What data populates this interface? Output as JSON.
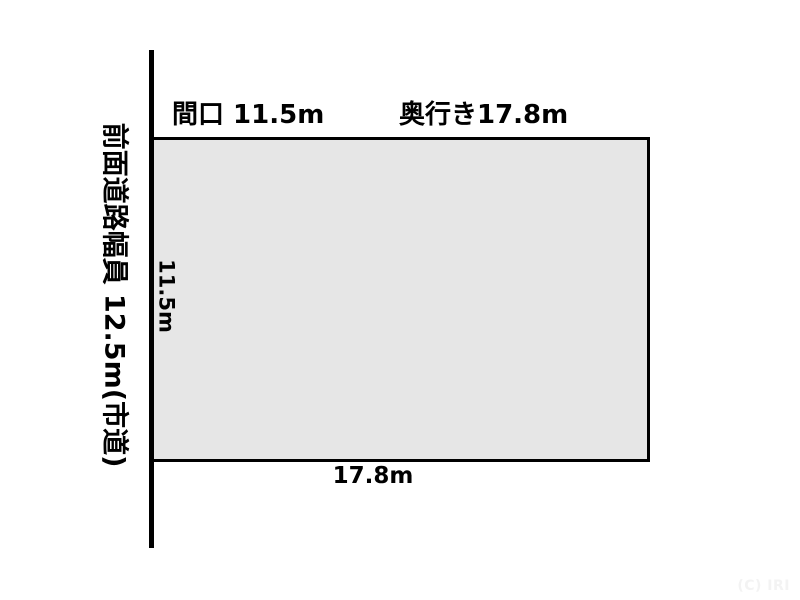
{
  "diagram": {
    "background_color": "#ffffff",
    "plot": {
      "fill_color": "#e6e6e6",
      "stroke_color": "#000000",
      "frontage_m": 11.5,
      "depth_m": 17.8
    },
    "road": {
      "label": "前面道路幅員 12.5m(市道)",
      "width_m": 12.5,
      "type": "市道",
      "line_color": "#000000"
    },
    "labels": {
      "frontage_header": "間口 11.5m",
      "depth_header": "奥行き17.8m",
      "frontage_side": "11.5m",
      "depth_bottom": "17.8m"
    },
    "watermark": {
      "text": "(C) IRI",
      "color": "#f3f3f3"
    }
  }
}
